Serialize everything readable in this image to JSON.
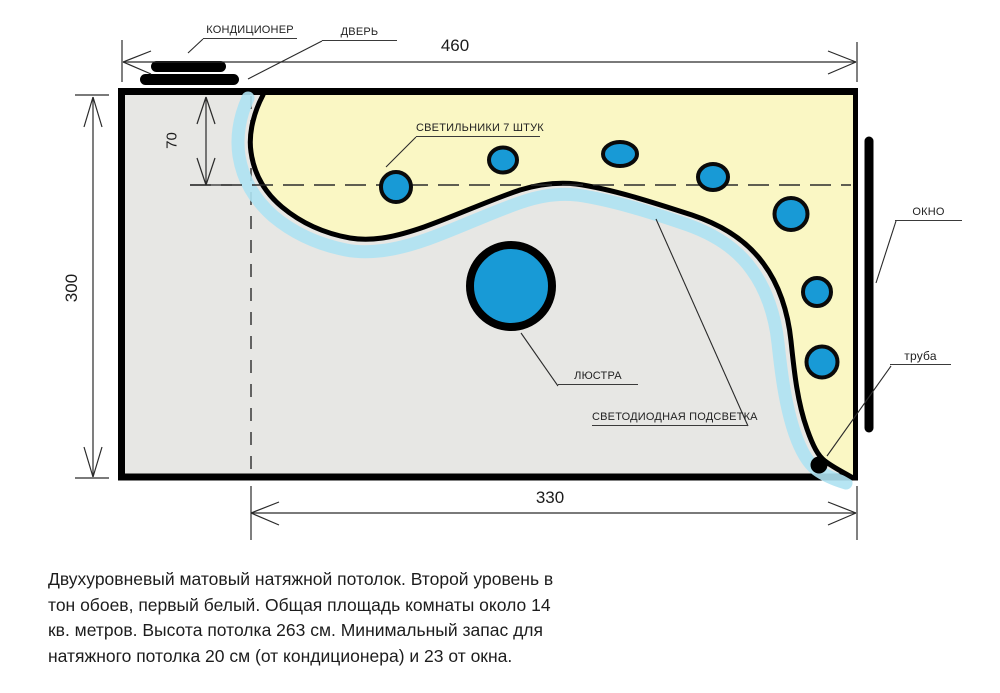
{
  "plan": {
    "labels": {
      "air_conditioner": "КОНДИЦИОНЕР",
      "door": "ДВЕРЬ",
      "spotlights": "СВЕТИЛЬНИКИ 7 ШТУК",
      "window": "ОКНО",
      "pipe": "труба",
      "chandelier": "ЛЮСТРА",
      "led_strip": "СВЕТОДИОДНАЯ ПОДСВЕТКА"
    },
    "dimensions": {
      "top_width_cm": "460",
      "left_height_cm": "300",
      "second_level_offset_cm": "70",
      "bottom_width_cm": "330"
    },
    "spotlights_count": 7,
    "spotlights": [
      {
        "cx": 396,
        "cy": 187,
        "rx": 15,
        "ry": 15
      },
      {
        "cx": 503,
        "cy": 160,
        "rx": 14,
        "ry": 12.5
      },
      {
        "cx": 620,
        "cy": 154,
        "rx": 17,
        "ry": 12
      },
      {
        "cx": 713,
        "cy": 177,
        "rx": 15,
        "ry": 13
      },
      {
        "cx": 791,
        "cy": 214,
        "rx": 16.5,
        "ry": 16
      },
      {
        "cx": 817,
        "cy": 292,
        "rx": 14,
        "ry": 14
      },
      {
        "cx": 822,
        "cy": 362,
        "rx": 15.5,
        "ry": 15.5
      }
    ],
    "chandelier": {
      "cx": 511,
      "cy": 286,
      "r": 41
    },
    "colors": {
      "second_level_fill": "#faf7c4",
      "first_level_fill": "#e7e7e4",
      "fixture_blue": "#189ad6",
      "led_strip_blue": "#aee2f2",
      "outline": "#000000"
    }
  },
  "description": {
    "lines": [
      "Двухуровневый матовый натяжной потолок. Второй уровень в",
      "тон обоев, первый белый. Общая площадь комнаты около 14",
      "кв. метров. Высота потолка 263 см. Минимальный запас для",
      "натяжного потолка 20 см (от кондиционера) и 23 от окна."
    ]
  }
}
